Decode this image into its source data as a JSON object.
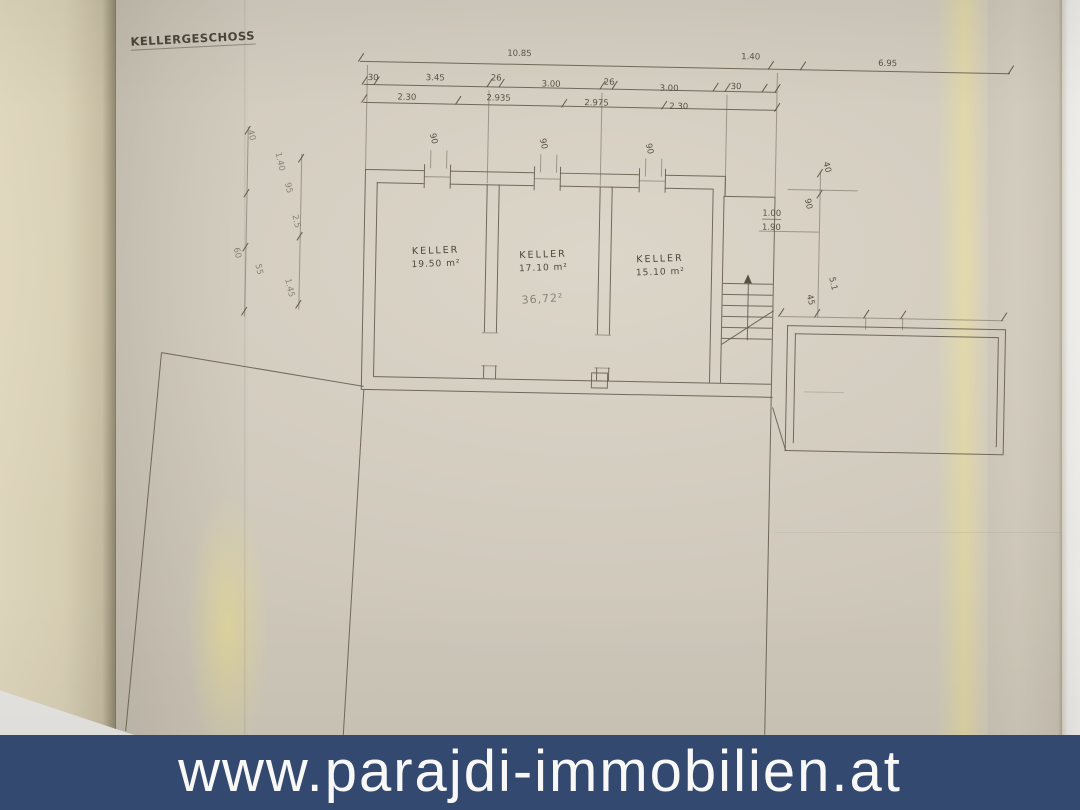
{
  "banner": {
    "url_text": "www.parajdi-immobilien.at",
    "bg_color": "#34496F",
    "text_color": "#F8F8F6"
  },
  "plan": {
    "title": "KELLERGESCHOSS",
    "rooms": [
      {
        "label": "KELLER",
        "area": "19.50 m²"
      },
      {
        "label": "KELLER",
        "area": "17.10 m²"
      },
      {
        "label": "KELLER",
        "area": "15.10 m²"
      }
    ],
    "pencil_area_note": "36,72²",
    "dims": {
      "total_width": "10.85",
      "right_extension": "1.40",
      "far_right": "6.95",
      "row2": [
        "30",
        "3.45",
        "26",
        "3.00",
        "26",
        "3.00",
        "30"
      ],
      "row3": [
        "2.30",
        "2.935",
        "2.975",
        "2.30"
      ],
      "window_widths": [
        "90",
        "90",
        "90"
      ],
      "left_column": [
        "40",
        "1.40",
        "95",
        "2.5",
        "60",
        "55",
        "1.45"
      ],
      "right_column": [
        "40",
        "90",
        "1.00",
        "1.90",
        "45",
        "5.1"
      ]
    }
  }
}
